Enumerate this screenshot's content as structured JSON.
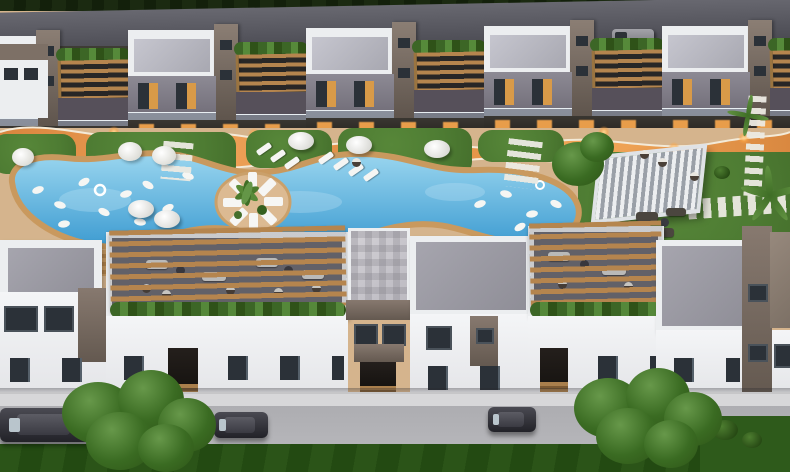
{
  "meta": {
    "description": "Aerial dusk 3D architectural render of a residential complex: two parallel rows of white two-storey townhouses with taupe stair towers, timber pergolas and lit ground floors, a winding illuminated orange walkway, a freeform blue swimming pool with a circular sun-deck island and palm, lawns with sun loungers, umbrellas and a slatted pergola lounge, and a front street with sidewalk, parked cars and large trees."
  },
  "colors": {
    "hedge": "#1b2a11",
    "road_top": "#595961",
    "white": "#eceef0",
    "roof_in": "#b3b3bc",
    "taupe": "#7d7066",
    "taupe_d": "#5e544c",
    "fac": "#8d8a94",
    "fac_d": "#6e6a75",
    "win": "#2b3138",
    "warm": "#e9a94f",
    "glow": "#f3a44c",
    "wood": "#b5854e",
    "wood_d": "#8a6336",
    "deck": "#d5b48d",
    "deck_edge": "#c9995e",
    "grass": "#4e7c33",
    "grass_d": "#35601f",
    "pool_light": "#9ad6ef",
    "pool_deep": "#3d9bd1",
    "roof_gray": "#9b9aa2",
    "sidewalk": "#d7d7d9",
    "road_b": "#b5b5b9",
    "grass_b": "#2b5418",
    "tree_light": "#67984a",
    "tree_dark": "#2e5417",
    "car": "#33333a",
    "furn": "#f5f5f3",
    "terr": "#6e6d74"
  },
  "scene": {
    "rear_buildings": {
      "count": 5,
      "style": "white roofs, taupe stair towers, timber pergola terraces, warm lit ground floors"
    },
    "walkway": {
      "style": "winding orange illuminated path with white curbs",
      "lights": 11
    },
    "pool": {
      "shape": "freeform curved",
      "island": {
        "loungers": 8,
        "palms": 1
      }
    },
    "pool_floats": 15,
    "umbrellas": 5,
    "daybeds": 3,
    "loungers": 7,
    "pergola_lounge": {
      "location": "east lawn",
      "roof": "white slatted"
    },
    "stepping_paths": 5,
    "front_buildings": {
      "count": 6,
      "features": "rooftop terraces with timber pergola slats, planter hedges, lounge furniture, street-level entrances"
    },
    "street": {
      "cars_parked": 3,
      "van_parked": 1,
      "large_trees": 2
    }
  }
}
